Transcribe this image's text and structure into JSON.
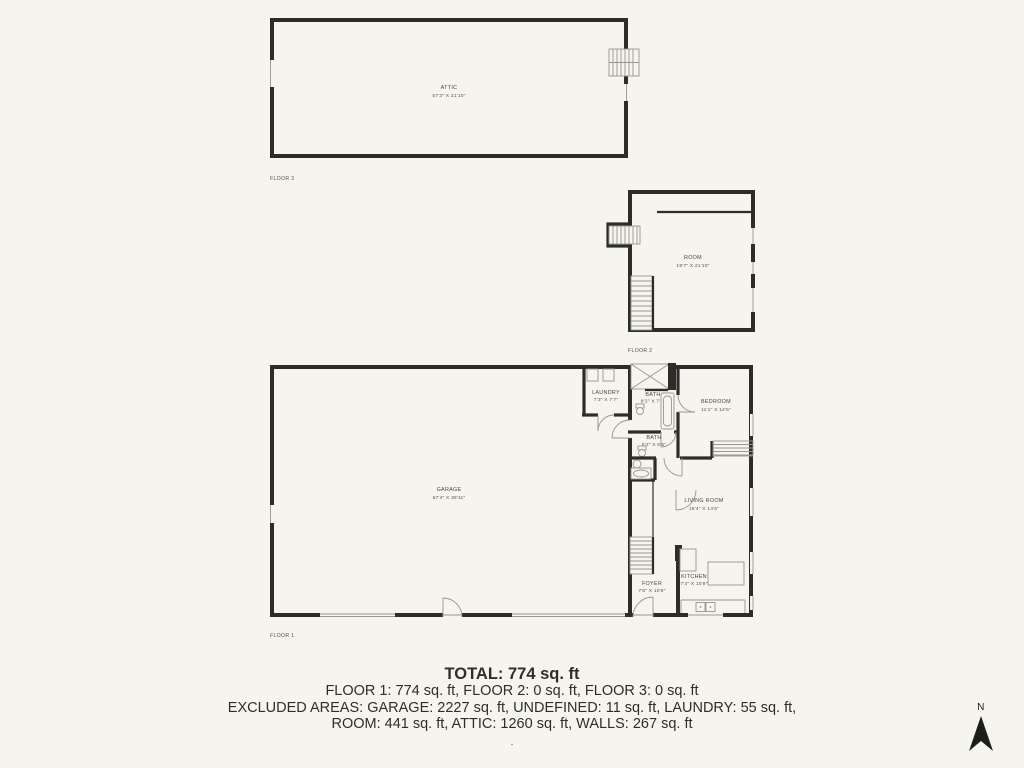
{
  "floors": [
    {
      "label": "FLOOR 3",
      "rooms": [
        {
          "name": "ATTIC",
          "dims": "57'3\" X 21'10\""
        }
      ]
    },
    {
      "label": "FLOOR 2",
      "rooms": [
        {
          "name": "ROOM",
          "dims": "19'7\" X 21'10\""
        }
      ]
    },
    {
      "label": "FLOOR 1",
      "rooms": [
        {
          "name": "GARAGE",
          "dims": "57'4\" X 39'11\""
        },
        {
          "name": "LAUNDRY",
          "dims": "7'3\" X 7'7\""
        },
        {
          "name": "BATH",
          "dims": "8'2\" X 7'7\""
        },
        {
          "name": "BATH",
          "dims": "8'2\" X 6'6\""
        },
        {
          "name": "BEDROOM",
          "dims": "11'1\" X 14'5\""
        },
        {
          "name": "LIVING ROOM",
          "dims": "16'4\" X 14'6\""
        },
        {
          "name": "FOYER",
          "dims": "7'6\" X 10'8\""
        },
        {
          "name": "KITCHEN",
          "dims": "7'4\" X 10'9\""
        }
      ]
    }
  ],
  "summary": {
    "total": "TOTAL: 774 sq. ft",
    "floor_totals": "FLOOR 1: 774 sq. ft, FLOOR 2: 0 sq. ft, FLOOR 3: 0 sq. ft",
    "excluded_line_1": "EXCLUDED AREAS: GARAGE: 2227 sq. ft, UNDEFINED: 11 sq. ft, LAUNDRY: 55 sq. ft,",
    "excluded_line_2": "ROOM: 441 sq. ft, ATTIC: 1260 sq. ft, WALLS: 267 sq. ft",
    "footnote": "."
  },
  "compass": {
    "label": "N"
  },
  "colors": {
    "background": "#f5f4ee",
    "wall": "#2d2c29",
    "thin_line": "#97968d",
    "label_text": "#48473f",
    "summary_text": "#2f2e29"
  }
}
